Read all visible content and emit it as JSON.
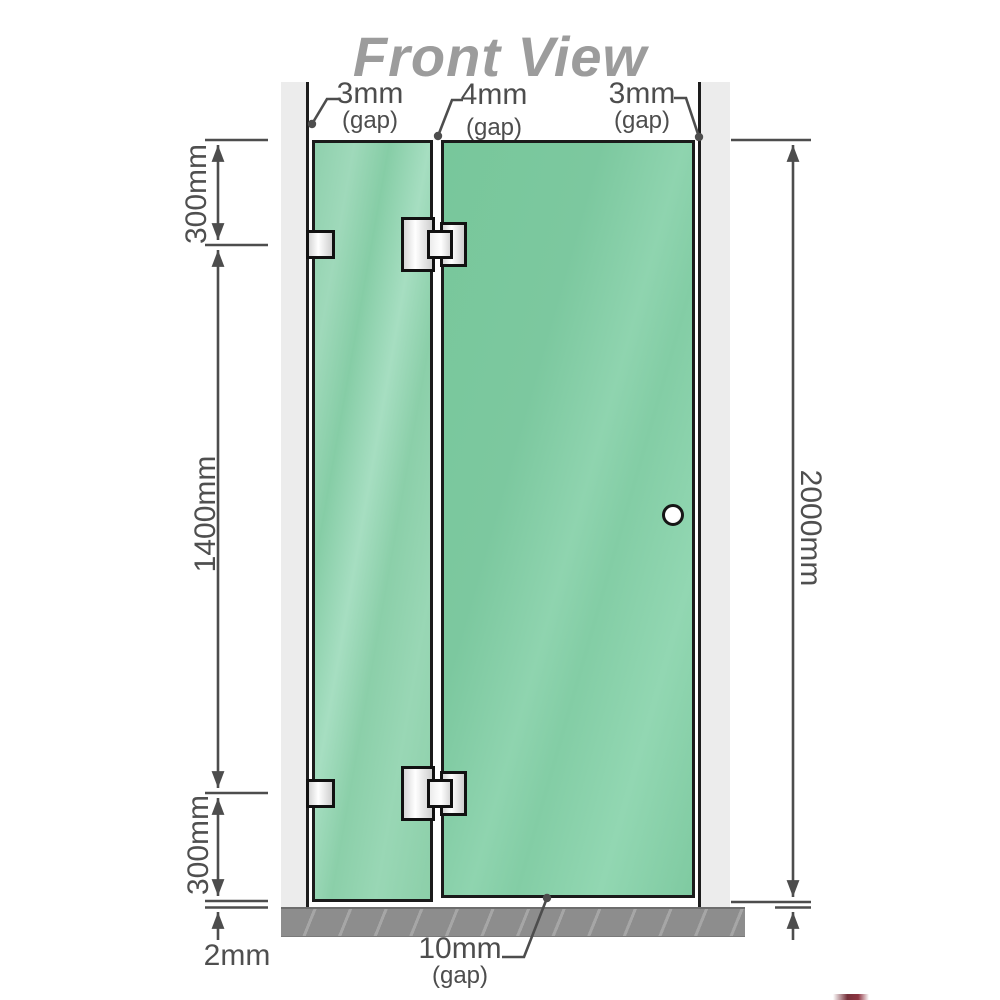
{
  "title": "Front View",
  "labels": {
    "gap_top_left": {
      "value": "3mm",
      "suffix": "(gap)"
    },
    "gap_top_mid": {
      "value": "4mm",
      "suffix": "(gap)"
    },
    "gap_top_right": {
      "value": "3mm",
      "suffix": "(gap)"
    },
    "height_top": "300mm",
    "height_mid": "1400mm",
    "height_bottom": "300mm",
    "floor_clearance": "2mm",
    "total_height": "2000mm",
    "gap_bottom": {
      "value": "10mm",
      "suffix": "(gap)"
    }
  },
  "colors": {
    "glass_green": "#7fcaa2",
    "wall_gray": "#ececec",
    "floor_gray": "#8d8d8d",
    "outline_black": "#1b1b1b",
    "dimension_gray": "#4d4d4d",
    "title_gray": "#9c9c9c",
    "hardware_metal": "#e8e8e8"
  },
  "components": {
    "left_wall": "wall",
    "right_wall": "wall",
    "fixed_panel": "glass panel with 2 wall brackets",
    "door_panel": "hinged glass door with knob",
    "hinges": 2,
    "wall_brackets": 2,
    "floor": "base strip"
  }
}
